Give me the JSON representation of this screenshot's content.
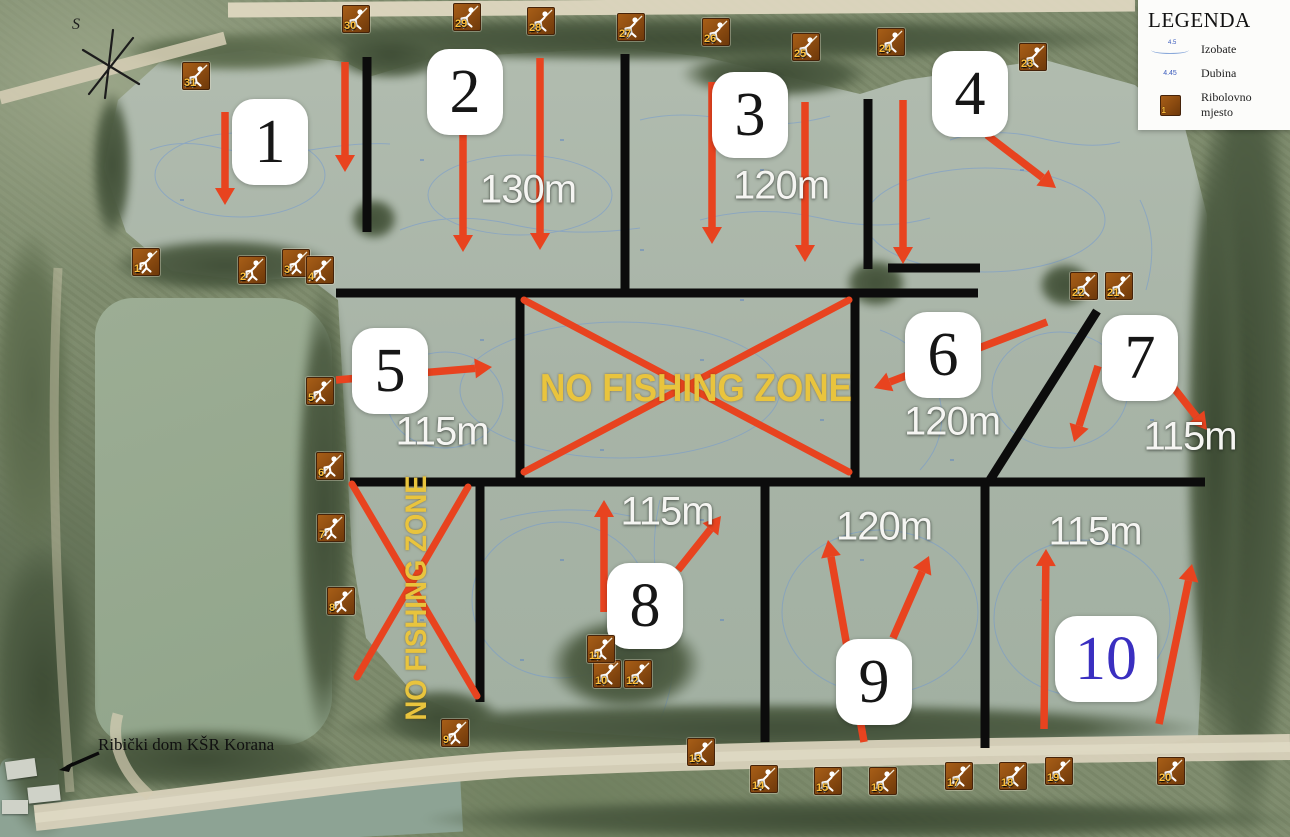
{
  "legend": {
    "title": "LEGENDA",
    "items": [
      {
        "label": "Izobate",
        "symbol": "isobath-line",
        "symbol_text": "4.5"
      },
      {
        "label": "Dubina",
        "symbol": "depth-number",
        "symbol_text": "4.45"
      },
      {
        "label": "Ribolovno mjesto",
        "symbol": "fishing-spot-marker",
        "symbol_text": "1"
      }
    ]
  },
  "compass": {
    "label": "S"
  },
  "club": {
    "text": "Ribički dom KŠR Korana"
  },
  "colors": {
    "boundary": "#0c0c0c",
    "arrow_red": "#e8431f",
    "nfz_yellow": "#e9c43d",
    "water": "#a8b4a7",
    "contour_blue": "#6e97d4",
    "marker_brown": "#8a4a10",
    "zone10_blue": "#3a2fc0"
  },
  "zones": [
    {
      "n": "1",
      "x": 270,
      "y": 142
    },
    {
      "n": "2",
      "x": 465,
      "y": 92
    },
    {
      "n": "3",
      "x": 750,
      "y": 115
    },
    {
      "n": "4",
      "x": 970,
      "y": 94
    },
    {
      "n": "5",
      "x": 390,
      "y": 371
    },
    {
      "n": "6",
      "x": 943,
      "y": 355
    },
    {
      "n": "7",
      "x": 1140,
      "y": 358
    },
    {
      "n": "8",
      "x": 645,
      "y": 606
    },
    {
      "n": "9",
      "x": 874,
      "y": 682
    },
    {
      "n": "10",
      "x": 1106,
      "y": 659,
      "w": 102,
      "color": "#3a2fc0"
    }
  ],
  "distances": [
    {
      "zone": "2",
      "t": "130m",
      "x": 528,
      "y": 190
    },
    {
      "zone": "3",
      "t": "120m",
      "x": 781,
      "y": 186
    },
    {
      "zone": "5",
      "t": "115m",
      "x": 442,
      "y": 432
    },
    {
      "zone": "6",
      "t": "120m",
      "x": 952,
      "y": 422
    },
    {
      "zone": "7",
      "t": "115m",
      "x": 1190,
      "y": 437
    },
    {
      "zone": "8",
      "t": "115m",
      "x": 667,
      "y": 512
    },
    {
      "zone": "9",
      "t": "120m",
      "x": 884,
      "y": 527
    },
    {
      "zone": "10",
      "t": "115m",
      "x": 1095,
      "y": 532
    }
  ],
  "no_fishing_zones": [
    {
      "label": "NO FISHING ZONE",
      "orientation": "horizontal",
      "cross": [
        [
          524,
          300,
          849,
          472
        ],
        [
          849,
          300,
          524,
          472
        ]
      ]
    },
    {
      "label": "NO FISHING ZONE",
      "orientation": "vertical",
      "cross": [
        [
          352,
          484,
          477,
          696
        ],
        [
          468,
          487,
          357,
          677
        ]
      ]
    }
  ],
  "boundaries": [
    [
      367,
      57,
      367,
      232
    ],
    [
      625,
      54,
      625,
      295
    ],
    [
      868,
      99,
      868,
      269
    ],
    [
      888,
      268,
      980,
      268
    ],
    [
      336,
      293,
      978,
      293
    ],
    [
      520,
      293,
      520,
      482
    ],
    [
      855,
      293,
      855,
      482
    ],
    [
      350,
      482,
      1205,
      482
    ],
    [
      1097,
      311,
      990,
      480
    ],
    [
      480,
      482,
      480,
      702
    ],
    [
      765,
      482,
      765,
      742
    ],
    [
      985,
      482,
      985,
      748
    ]
  ],
  "arrows": [
    [
      225,
      112,
      225,
      205
    ],
    [
      345,
      62,
      345,
      172
    ],
    [
      463,
      130,
      463,
      252
    ],
    [
      540,
      58,
      540,
      250
    ],
    [
      712,
      82,
      712,
      244
    ],
    [
      805,
      102,
      805,
      262
    ],
    [
      903,
      100,
      903,
      264
    ],
    [
      987,
      135,
      1056,
      188
    ],
    [
      336,
      380,
      492,
      367
    ],
    [
      1047,
      322,
      874,
      388
    ],
    [
      1098,
      366,
      1074,
      442
    ],
    [
      1170,
      383,
      1207,
      430
    ],
    [
      604,
      612,
      604,
      500
    ],
    [
      678,
      570,
      721,
      516
    ],
    [
      864,
      742,
      828,
      540
    ],
    [
      893,
      638,
      929,
      556
    ],
    [
      1044,
      729,
      1046,
      549
    ],
    [
      1159,
      724,
      1192,
      564
    ]
  ],
  "markers": [
    {
      "n": "1",
      "x": 146,
      "y": 262
    },
    {
      "n": "2",
      "x": 252,
      "y": 270
    },
    {
      "n": "3",
      "x": 296,
      "y": 263
    },
    {
      "n": "4",
      "x": 320,
      "y": 270
    },
    {
      "n": "5",
      "x": 320,
      "y": 391
    },
    {
      "n": "6",
      "x": 330,
      "y": 466
    },
    {
      "n": "7",
      "x": 331,
      "y": 528
    },
    {
      "n": "8",
      "x": 341,
      "y": 601
    },
    {
      "n": "9",
      "x": 455,
      "y": 733
    },
    {
      "n": "10",
      "x": 607,
      "y": 674
    },
    {
      "n": "11",
      "x": 601,
      "y": 649
    },
    {
      "n": "12",
      "x": 638,
      "y": 674
    },
    {
      "n": "13",
      "x": 701,
      "y": 752
    },
    {
      "n": "14",
      "x": 764,
      "y": 779
    },
    {
      "n": "15",
      "x": 828,
      "y": 781
    },
    {
      "n": "16",
      "x": 883,
      "y": 781
    },
    {
      "n": "17",
      "x": 959,
      "y": 776
    },
    {
      "n": "18",
      "x": 1013,
      "y": 776
    },
    {
      "n": "19",
      "x": 1059,
      "y": 771
    },
    {
      "n": "20",
      "x": 1171,
      "y": 771
    },
    {
      "n": "21",
      "x": 1119,
      "y": 286
    },
    {
      "n": "22",
      "x": 1084,
      "y": 286
    },
    {
      "n": "23",
      "x": 1033,
      "y": 57
    },
    {
      "n": "24",
      "x": 891,
      "y": 42
    },
    {
      "n": "25",
      "x": 806,
      "y": 47
    },
    {
      "n": "26",
      "x": 716,
      "y": 32
    },
    {
      "n": "27",
      "x": 631,
      "y": 27
    },
    {
      "n": "28",
      "x": 541,
      "y": 21
    },
    {
      "n": "29",
      "x": 467,
      "y": 17
    },
    {
      "n": "30",
      "x": 356,
      "y": 19
    },
    {
      "n": "31",
      "x": 196,
      "y": 76
    }
  ]
}
